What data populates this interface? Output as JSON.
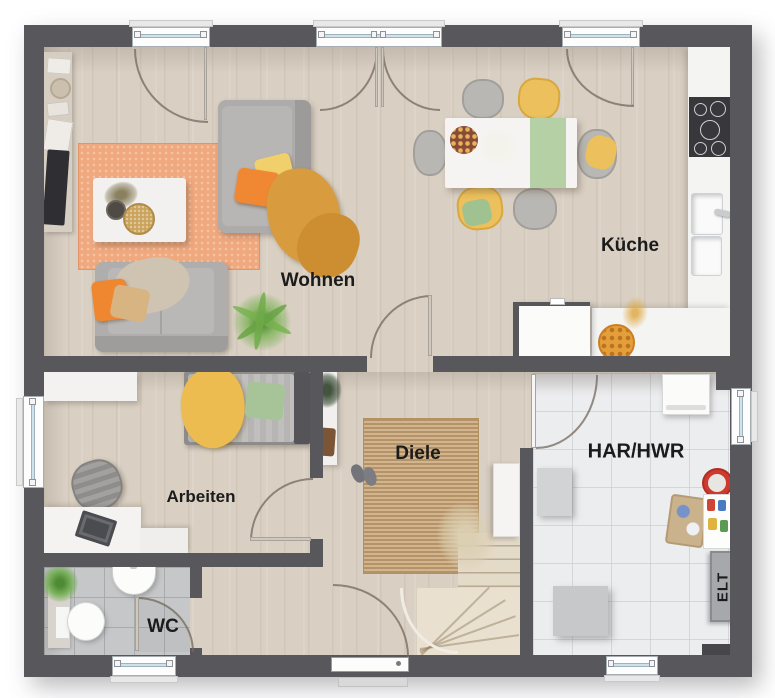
{
  "plan": {
    "rooms": {
      "living": {
        "label": "Wohnen"
      },
      "kitchen": {
        "label": "Küche"
      },
      "office": {
        "label": "Arbeiten"
      },
      "hall": {
        "label": "Diele"
      },
      "wc": {
        "label": "WC"
      },
      "utility": {
        "label": "HAR/HWR"
      },
      "electrical": {
        "label": "ELT"
      }
    },
    "colors": {
      "wall": "#58575b",
      "wood_floor": "#d9d0c3",
      "wc_tile": "#c6c7c9",
      "utility_tile": "#ecedef",
      "living_rug": "#f0a97e",
      "hall_rug": "#c8a67a",
      "accent_orange": "#f08833",
      "accent_yellow": "#ecc05c",
      "accent_green": "#a6c498"
    }
  }
}
